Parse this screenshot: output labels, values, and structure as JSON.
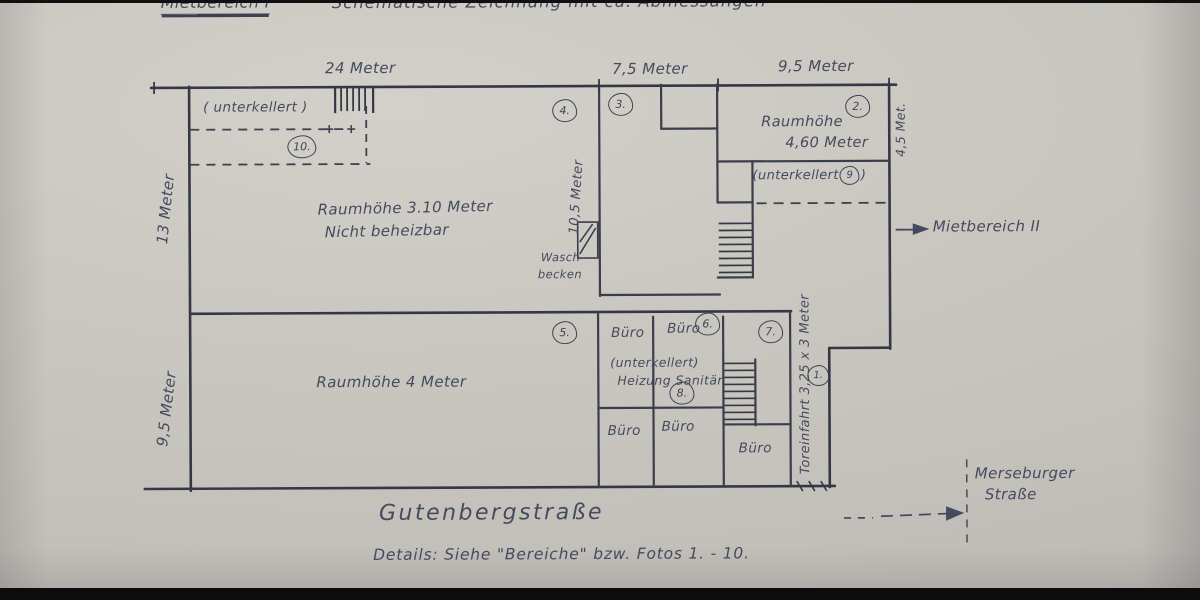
{
  "colors": {
    "paper": "#c9c6c0",
    "ink": "#454b5e",
    "wall": "#343845"
  },
  "title": {
    "section": "Mietbereich I",
    "main": "Schematische Zeichnung mit ca. Abmessungen"
  },
  "dimensions": {
    "top_left": "24 Meter",
    "top_middle": "7,5 Meter",
    "top_right": "9,5 Meter",
    "left_upper": "13 Meter",
    "left_lower": "9,5 Meter",
    "right_upper": "4,5 Met.",
    "middle_vertical": "10,5 Meter",
    "gate": "Toreinfahrt   3,25 x 3 Meter"
  },
  "areas": {
    "a1": "1.",
    "a2": "2.",
    "a3": "3.",
    "a4": "4.",
    "a5": "5.",
    "a6": "6.",
    "a7": "7.",
    "a8": "8.",
    "a9": "9",
    "a10": "10."
  },
  "rooms": {
    "cellar_upper_left": "( unterkellert )",
    "upper_hall_line1": "Raumhöhe  3.10 Meter",
    "upper_hall_line2": "Nicht beheizbar",
    "room2_line1": "Raumhöhe",
    "room2_line2": "4,60 Meter",
    "cellar_right_open": "(unterkellert",
    "cellar_right_close": ")",
    "sink_line1": "Wasch-",
    "sink_line2": "becken",
    "lower_hall": "Raumhöhe   4 Meter",
    "office": "Büro",
    "cellar_mid_line1": "(unterkellert)",
    "cellar_mid_line2": "Heizung Sanitär"
  },
  "annotations": {
    "mietbereich_2": "Mietbereich II",
    "street_bottom": "Gutenbergstraße",
    "street_right_line1": "Merseburger",
    "street_right_line2": "Straße",
    "details": "Details:  Siehe  \"Bereiche\"  bzw.  Fotos 1. - 10."
  }
}
